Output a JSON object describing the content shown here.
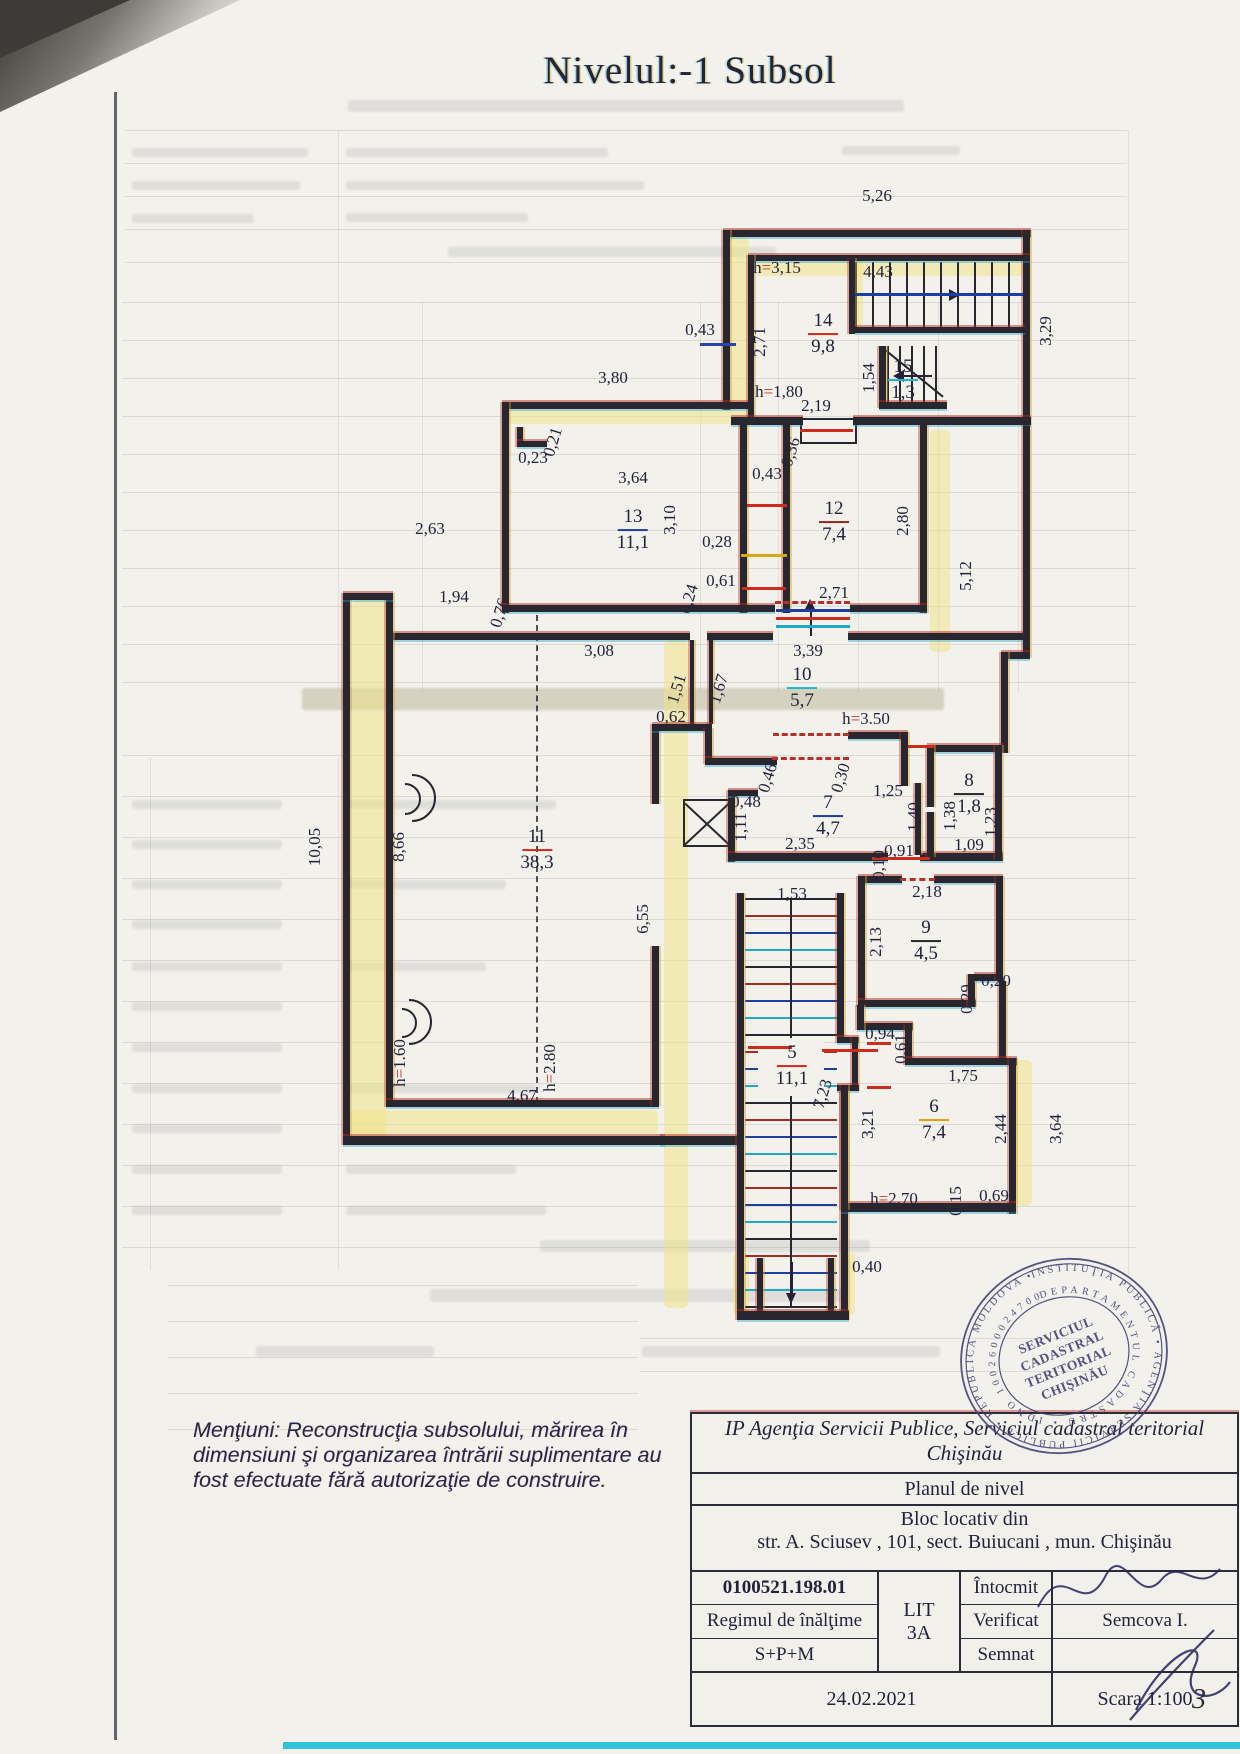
{
  "page": {
    "title": "Nivelul:-1 Subsol",
    "page_number": "3"
  },
  "plan": {
    "rooms": [
      {
        "num": "14",
        "area": "9,8",
        "x": 823,
        "y": 334,
        "bar": "#cf2b1d"
      },
      {
        "num": "15",
        "area": "1,3",
        "x": 903,
        "y": 380,
        "bar": "#1fb6c9"
      },
      {
        "num": "13",
        "area": "11,1",
        "x": 633,
        "y": 530,
        "bar": "#1d3fa0"
      },
      {
        "num": "12",
        "area": "7,4",
        "x": 834,
        "y": 522,
        "bar": "#8c2a22"
      },
      {
        "num": "10",
        "area": "5,7",
        "x": 802,
        "y": 688,
        "bar": "#1fb6c9"
      },
      {
        "num": "11",
        "area": "38,3",
        "x": 537,
        "y": 850,
        "bar": "#cf2b1d"
      },
      {
        "num": "7",
        "area": "4,7",
        "x": 828,
        "y": 816,
        "bar": "#1d3fa0"
      },
      {
        "num": "8",
        "area": "1,8",
        "x": 969,
        "y": 794,
        "bar": "#28262f"
      },
      {
        "num": "9",
        "area": "4,5",
        "x": 926,
        "y": 941,
        "bar": "#28262f"
      },
      {
        "num": "5",
        "area": "11,1",
        "x": 792,
        "y": 1066,
        "bar": "#cf2b1d"
      },
      {
        "num": "6",
        "area": "7,4",
        "x": 934,
        "y": 1120,
        "bar": "#e0a112"
      }
    ],
    "labels": [
      {
        "t": "5,26",
        "x": 877,
        "y": 196
      },
      {
        "t": "3,29",
        "x": 1046,
        "y": 331,
        "r": 90
      },
      {
        "t": "4,43",
        "x": 878,
        "y": 272
      },
      {
        "t": "h=3,15",
        "x": 777,
        "y": 268
      },
      {
        "t": "2,71",
        "x": 760,
        "y": 342,
        "r": 90
      },
      {
        "t": "0,43",
        "x": 700,
        "y": 330
      },
      {
        "t": "1,54",
        "x": 869,
        "y": 378,
        "r": 90
      },
      {
        "t": "h=1,80",
        "x": 779,
        "y": 392
      },
      {
        "t": "2,19",
        "x": 816,
        "y": 406
      },
      {
        "t": "0,36",
        "x": 791,
        "y": 452,
        "r": 73
      },
      {
        "t": "3,80",
        "x": 613,
        "y": 378
      },
      {
        "t": "0,23",
        "x": 533,
        "y": 458
      },
      {
        "t": "0,21",
        "x": 553,
        "y": 442,
        "r": 73
      },
      {
        "t": "3,64",
        "x": 633,
        "y": 478
      },
      {
        "t": "3,10",
        "x": 670,
        "y": 520,
        "r": 90
      },
      {
        "t": "0,43",
        "x": 767,
        "y": 474
      },
      {
        "t": "0,28",
        "x": 717,
        "y": 542
      },
      {
        "t": "0,61",
        "x": 721,
        "y": 581
      },
      {
        "t": "2,80",
        "x": 903,
        "y": 521,
        "r": 90
      },
      {
        "t": "2,63",
        "x": 430,
        "y": 529
      },
      {
        "t": "5,12",
        "x": 966,
        "y": 576,
        "r": 90
      },
      {
        "t": "0,24",
        "x": 689,
        "y": 599,
        "r": 73
      },
      {
        "t": "1,94",
        "x": 454,
        "y": 597
      },
      {
        "t": "0,76",
        "x": 500,
        "y": 613,
        "r": 73
      },
      {
        "t": "2,71",
        "x": 834,
        "y": 593
      },
      {
        "t": "3,08",
        "x": 599,
        "y": 651
      },
      {
        "t": "3,39",
        "x": 808,
        "y": 651
      },
      {
        "t": "1,51",
        "x": 677,
        "y": 689,
        "r": 73
      },
      {
        "t": "1,67",
        "x": 719,
        "y": 689,
        "r": 73
      },
      {
        "t": "0,62",
        "x": 671,
        "y": 717
      },
      {
        "t": "h=3.50",
        "x": 866,
        "y": 719
      },
      {
        "t": "0,46",
        "x": 768,
        "y": 778,
        "r": 73
      },
      {
        "t": "0,30",
        "x": 841,
        "y": 778,
        "r": 73
      },
      {
        "t": "0,48",
        "x": 746,
        "y": 802
      },
      {
        "t": "1,11",
        "x": 741,
        "y": 827,
        "r": 90
      },
      {
        "t": "2,35",
        "x": 800,
        "y": 844
      },
      {
        "t": "1,25",
        "x": 888,
        "y": 791
      },
      {
        "t": "1,40",
        "x": 914,
        "y": 817,
        "r": 90
      },
      {
        "t": "1,38",
        "x": 950,
        "y": 816,
        "r": 90
      },
      {
        "t": "1,23",
        "x": 991,
        "y": 822,
        "r": 90
      },
      {
        "t": "1,09",
        "x": 969,
        "y": 845
      },
      {
        "t": "0,10",
        "x": 879,
        "y": 865,
        "r": 90
      },
      {
        "t": "0,91",
        "x": 899,
        "y": 851
      },
      {
        "t": "2,18",
        "x": 927,
        "y": 892
      },
      {
        "t": "1,53",
        "x": 792,
        "y": 894
      },
      {
        "t": "2,13",
        "x": 876,
        "y": 942,
        "r": 90
      },
      {
        "t": "10,05",
        "x": 315,
        "y": 847,
        "r": 90
      },
      {
        "t": "8,66",
        "x": 399,
        "y": 847,
        "r": 90
      },
      {
        "t": "6,55",
        "x": 643,
        "y": 919,
        "r": 90
      },
      {
        "t": "h=1.60",
        "x": 400,
        "y": 1063,
        "r": 90
      },
      {
        "t": "4,67",
        "x": 522,
        "y": 1096
      },
      {
        "t": "h=2.80",
        "x": 550,
        "y": 1068,
        "r": 90
      },
      {
        "t": "0,29",
        "x": 967,
        "y": 999,
        "r": 90
      },
      {
        "t": "0,20",
        "x": 996,
        "y": 981
      },
      {
        "t": "0,94",
        "x": 880,
        "y": 1034
      },
      {
        "t": "0,61",
        "x": 901,
        "y": 1049,
        "r": 90
      },
      {
        "t": "1,75",
        "x": 963,
        "y": 1076
      },
      {
        "t": "7,23",
        "x": 823,
        "y": 1094,
        "r": 73
      },
      {
        "t": "3,21",
        "x": 868,
        "y": 1124,
        "r": 90
      },
      {
        "t": "2,44",
        "x": 1001,
        "y": 1129,
        "r": 90
      },
      {
        "t": "3,64",
        "x": 1056,
        "y": 1129,
        "r": 90
      },
      {
        "t": "h=2.70",
        "x": 894,
        "y": 1199
      },
      {
        "t": "0,15",
        "x": 956,
        "y": 1201,
        "r": 90
      },
      {
        "t": "0,69",
        "x": 994,
        "y": 1196
      },
      {
        "t": "0,40",
        "x": 867,
        "y": 1267
      }
    ]
  },
  "note": {
    "lines": [
      "Menţiuni: Reconstrucţia subsolului, mărirea în",
      "dimensiuni şi organizarea întrării suplimentare au",
      "fost efectuate fără autorizaţie de construire."
    ]
  },
  "title_block": {
    "org_line1": "IP Agenţia Servicii Publice, Serviciul cadastral teritorial",
    "org_line2": "Chişinău",
    "doc_type": "Planul de nivel",
    "object_line1": "Bloc locativ din",
    "object_line2": "str. A. Sciusev , 101, sect. Buiucani ,   mun. Chişinău",
    "cadastral_number": "0100521.198.01",
    "height_regime_label": "Regimul de înălţime",
    "height_regime_value": "S+P+M",
    "lit_label": "LIT",
    "lit_value": "3A",
    "rows": [
      {
        "label": "Întocmit",
        "name": ""
      },
      {
        "label": "Verificat",
        "name": "Semcova I."
      },
      {
        "label": "Semnat",
        "name": ""
      }
    ],
    "date": "24.02.2021",
    "scale": "Scara 1:100"
  },
  "stamp": {
    "ring_text": "INSTITUŢIA PUBLICĂ • AGENŢIA SERVICII PUBLICE • REPUBLICA MOLDOVA •",
    "ring_text_inner": "DEPARTAMENTUL CADASTRU • IDNO 1002600024700",
    "center_lines": [
      "SERVICIUL",
      "CADASTRAL",
      "TERITORIAL",
      "CHIŞINĂU"
    ]
  }
}
